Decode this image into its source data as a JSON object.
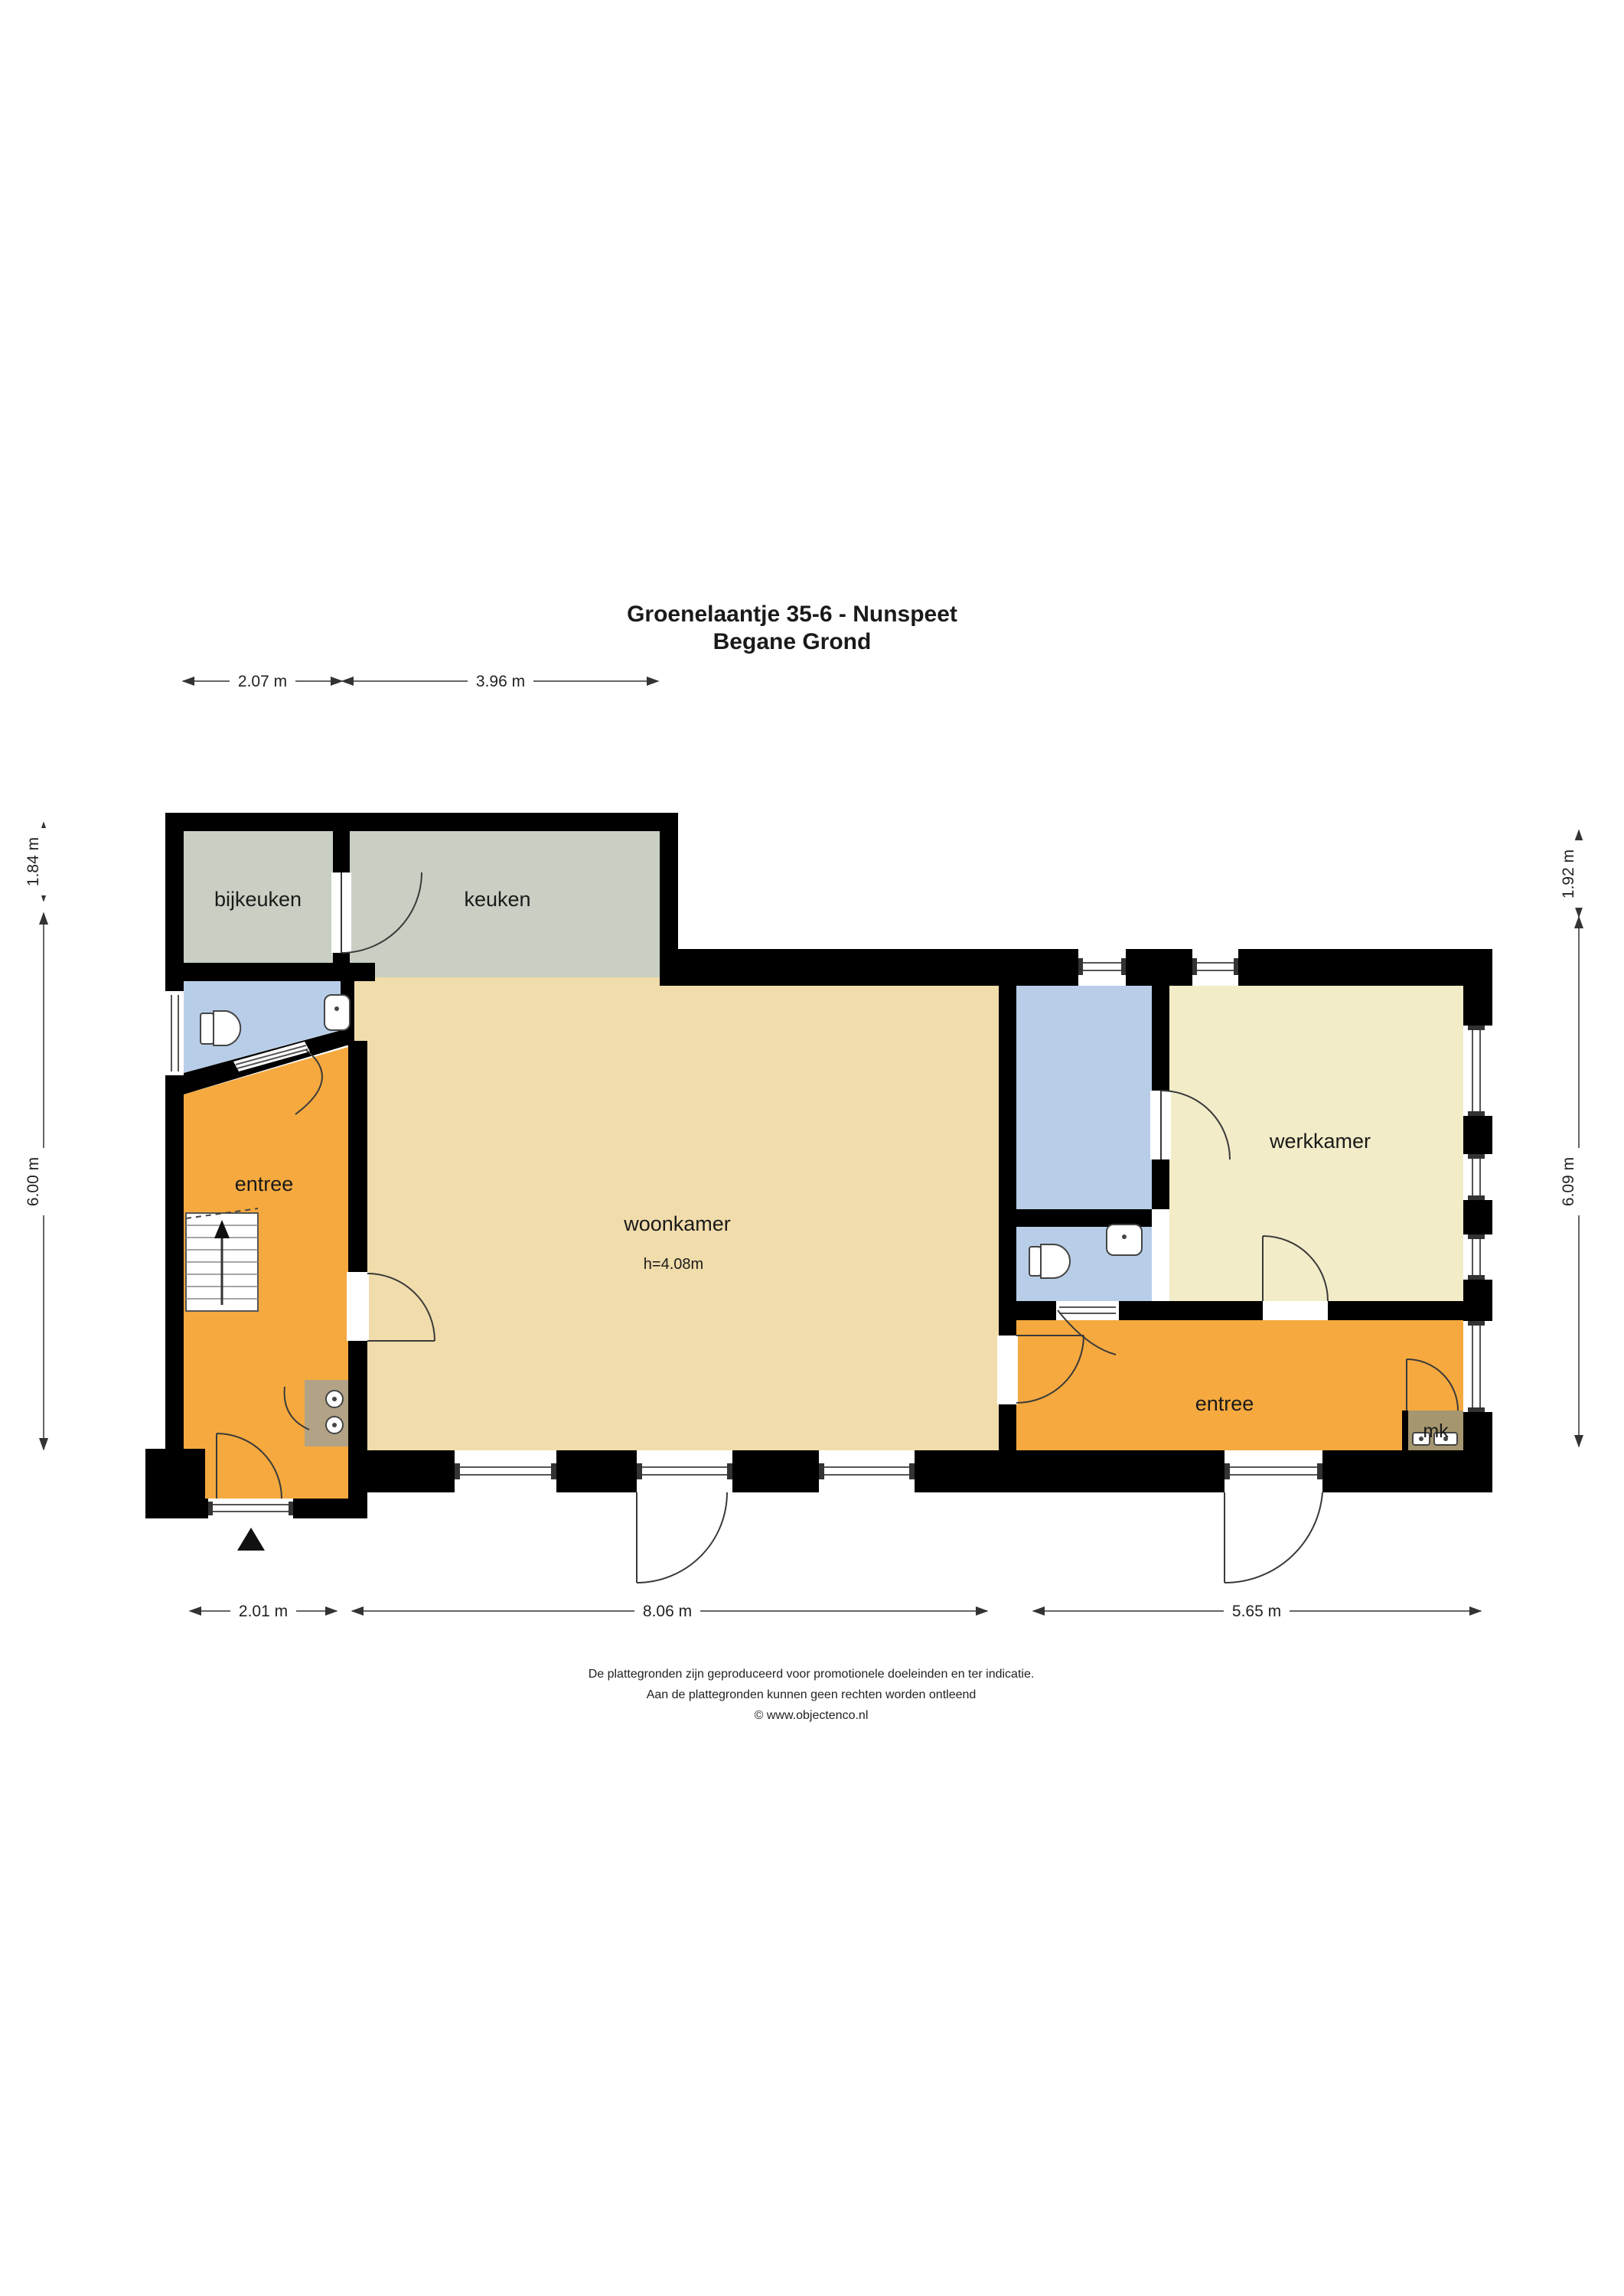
{
  "title": {
    "line1": "Groenelaantje 35-6 - Nunspeet",
    "line2": "Begane Grond"
  },
  "rooms": {
    "bijkeuken": "bijkeuken",
    "keuken": "keuken",
    "entree_left": "entree",
    "woonkamer": "woonkamer",
    "woonkamer_height": "h=4.08m",
    "werkkamer": "werkkamer",
    "entree_right": "entree",
    "mk": "mk"
  },
  "dimensions": {
    "top": [
      "2.07 m",
      "3.96 m"
    ],
    "left": [
      "1.84 m",
      "6.00 m"
    ],
    "right": [
      "1.92 m",
      "6.09 m"
    ],
    "bottom": [
      "2.01 m",
      "8.06 m",
      "5.65 m"
    ]
  },
  "footer": {
    "line1": "De plattegronden zijn geproduceerd voor promotionele doeleinden en ter indicatie.",
    "line2": "Aan de plattegronden kunnen geen rechten worden ontleend",
    "line3": "© www.objectenco.nl"
  },
  "colors": {
    "wall": "#000000",
    "kitchen": "#c9d0c3",
    "living": "#f1dcab",
    "hall": "#f5a93f",
    "bath": "#b8cee8",
    "study": "#f2ecc8",
    "mk": "#a5966f",
    "closet": "#b2a386"
  }
}
